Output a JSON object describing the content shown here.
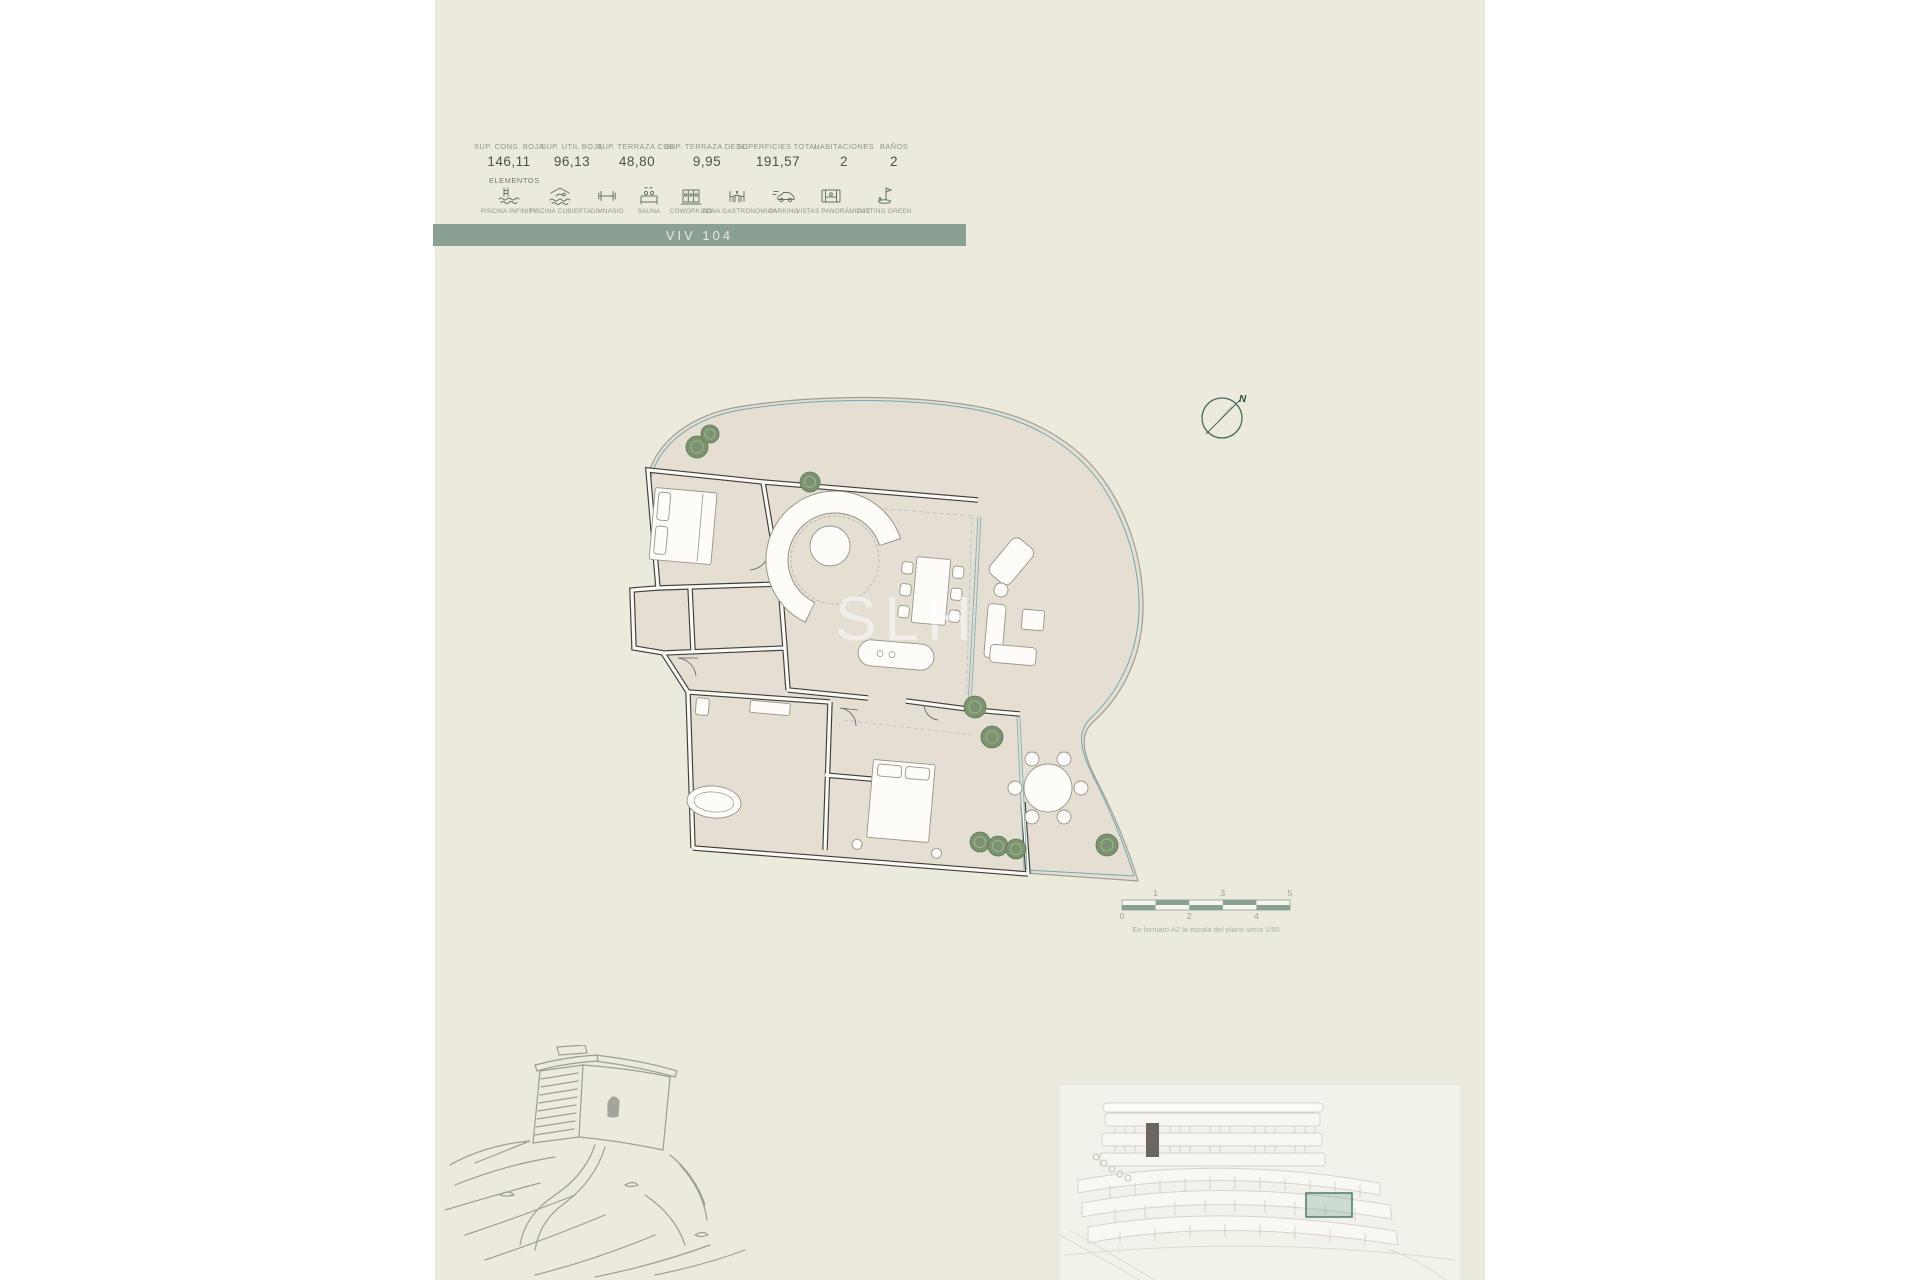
{
  "banner": {
    "title": "VIV 104",
    "color": "#8ba095"
  },
  "header": {
    "elements_label": "ELEMENTOS",
    "metrics": [
      {
        "label": "SUP. CONS. BOJA",
        "value": "146,11"
      },
      {
        "label": "SUP. UTIL BOJA",
        "value": "96,13"
      },
      {
        "label": "SUP. TERRAZA CUB.",
        "value": "48,80"
      },
      {
        "label": "SUP. TERRAZA DESC.",
        "value": "9,95"
      },
      {
        "label": "SUPERFICIES TOTAL",
        "value": "191,57"
      },
      {
        "label": "HABITACIONES",
        "value": "2"
      },
      {
        "label": "BAÑOS",
        "value": "2"
      }
    ],
    "amenities": [
      {
        "label": "PISCINA INFINITY",
        "icon": "infinity-pool-icon"
      },
      {
        "label": "PISCINA CUBIERTA",
        "icon": "indoor-pool-icon"
      },
      {
        "label": "GIMNASIO",
        "icon": "dumbbell-icon"
      },
      {
        "label": "SAUNA",
        "icon": "sauna-icon"
      },
      {
        "label": "COWORKING",
        "icon": "coworking-icon"
      },
      {
        "label": "ZONA GASTRONÓMICA",
        "icon": "dining-icon"
      },
      {
        "label": "PARKING",
        "icon": "car-icon"
      },
      {
        "label": "VISTAS PANORÁMICAS",
        "icon": "panoramic-view-icon"
      },
      {
        "label": "PUTTING GREEN",
        "icon": "golf-flag-icon"
      }
    ]
  },
  "plan": {
    "north_label": "N",
    "watermark": "SLH"
  },
  "scalebar": {
    "top_ticks": [
      "1",
      "3",
      "5"
    ],
    "bottom_ticks": [
      "0",
      "2",
      "4"
    ],
    "caption": "En formato A2 la escala del plano sería 1/50"
  },
  "colors": {
    "sheet": "#eceadc",
    "banner": "#8ba095",
    "terrace_floor": "#e5ded3",
    "wall": "#3f3f39",
    "terrace_edge_teal": "#73a8ac",
    "tree": "#7d9370",
    "highlight_box": "#4d7a68"
  }
}
